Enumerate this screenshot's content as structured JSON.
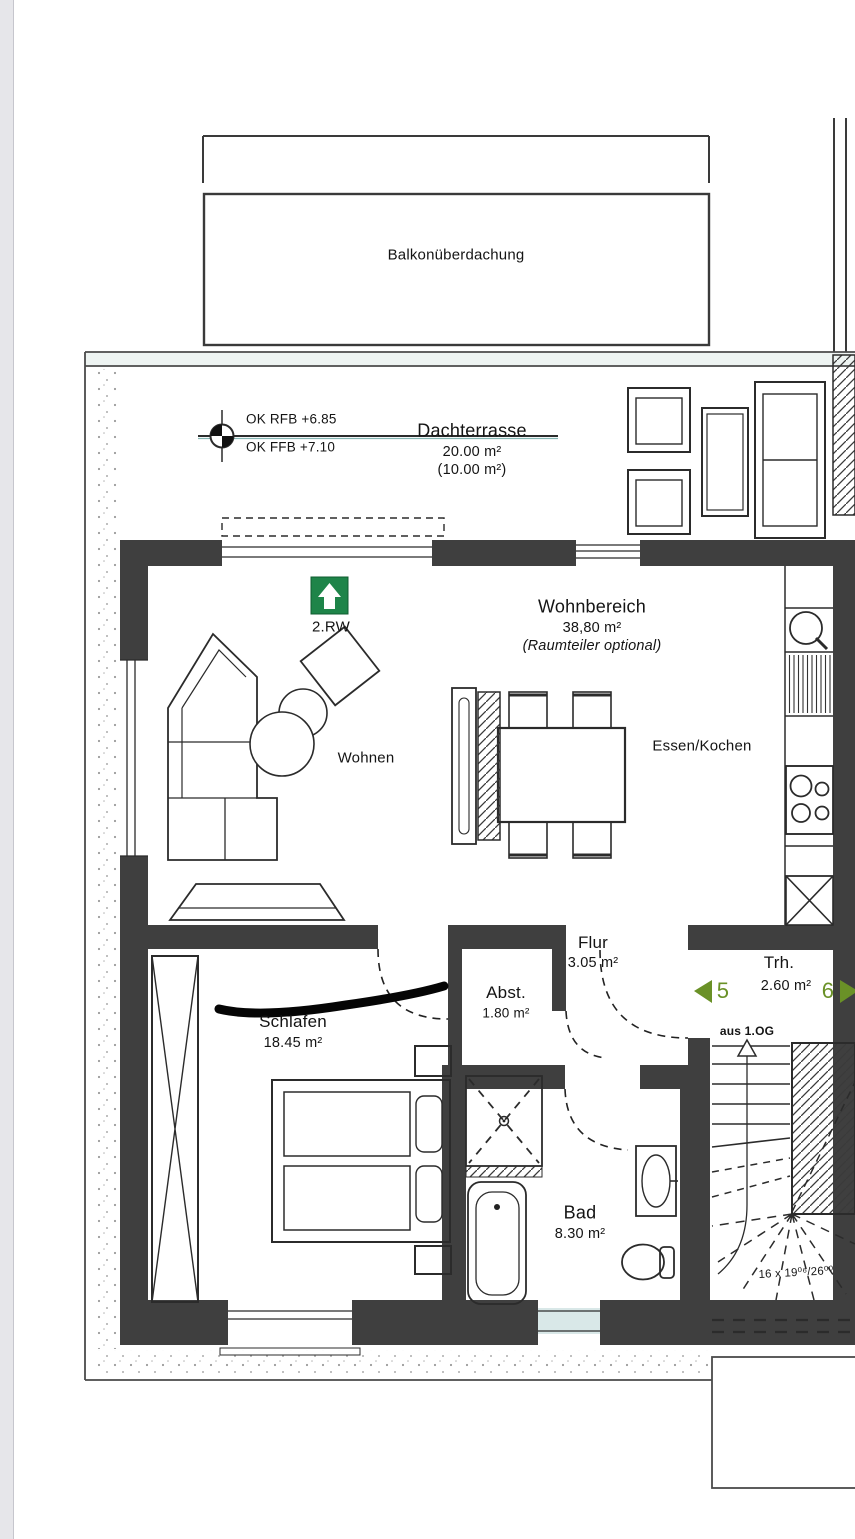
{
  "plan": {
    "balcony_roof_label": "Balkonüberdachung",
    "level_marker": {
      "line1": "OK RFB +6.85",
      "line2": "OK FFB +7.10"
    },
    "rooms": {
      "dachterrasse": {
        "name": "Dachterrasse",
        "area": "20.00 m²",
        "area_secondary": "(10.00 m²)"
      },
      "wohnbereich": {
        "name": "Wohnbereich",
        "area": "38,80 m²",
        "note": "(Raumteiler optional)"
      },
      "wohnen": {
        "name": "Wohnen"
      },
      "essen_kochen": {
        "name": "Essen/Kochen"
      },
      "flur": {
        "name": "Flur",
        "area": "3.05 m²"
      },
      "abstellraum": {
        "name": "Abst.",
        "area": "1.80 m²"
      },
      "treppenhaus": {
        "name": "Trh.",
        "area": "2.60 m²"
      },
      "schlafen": {
        "name": "Schlafen",
        "area": "18.45 m²"
      },
      "bad": {
        "name": "Bad",
        "area": "8.30 m²"
      }
    },
    "escape_sign": {
      "label": "2.RW"
    },
    "stair": {
      "from_label": "aus 1.OG",
      "steps_label": "16 x 19⁰⁶/26⁰⁰",
      "door_number_left": "5",
      "door_number_right": "6"
    },
    "colors": {
      "wall": "#3f3f3f",
      "sign_green": "#1e8449",
      "arrow_green": "#6a9127",
      "glass_tint": "#d9e8e8",
      "level_line_teal": "#86b6b4"
    }
  }
}
